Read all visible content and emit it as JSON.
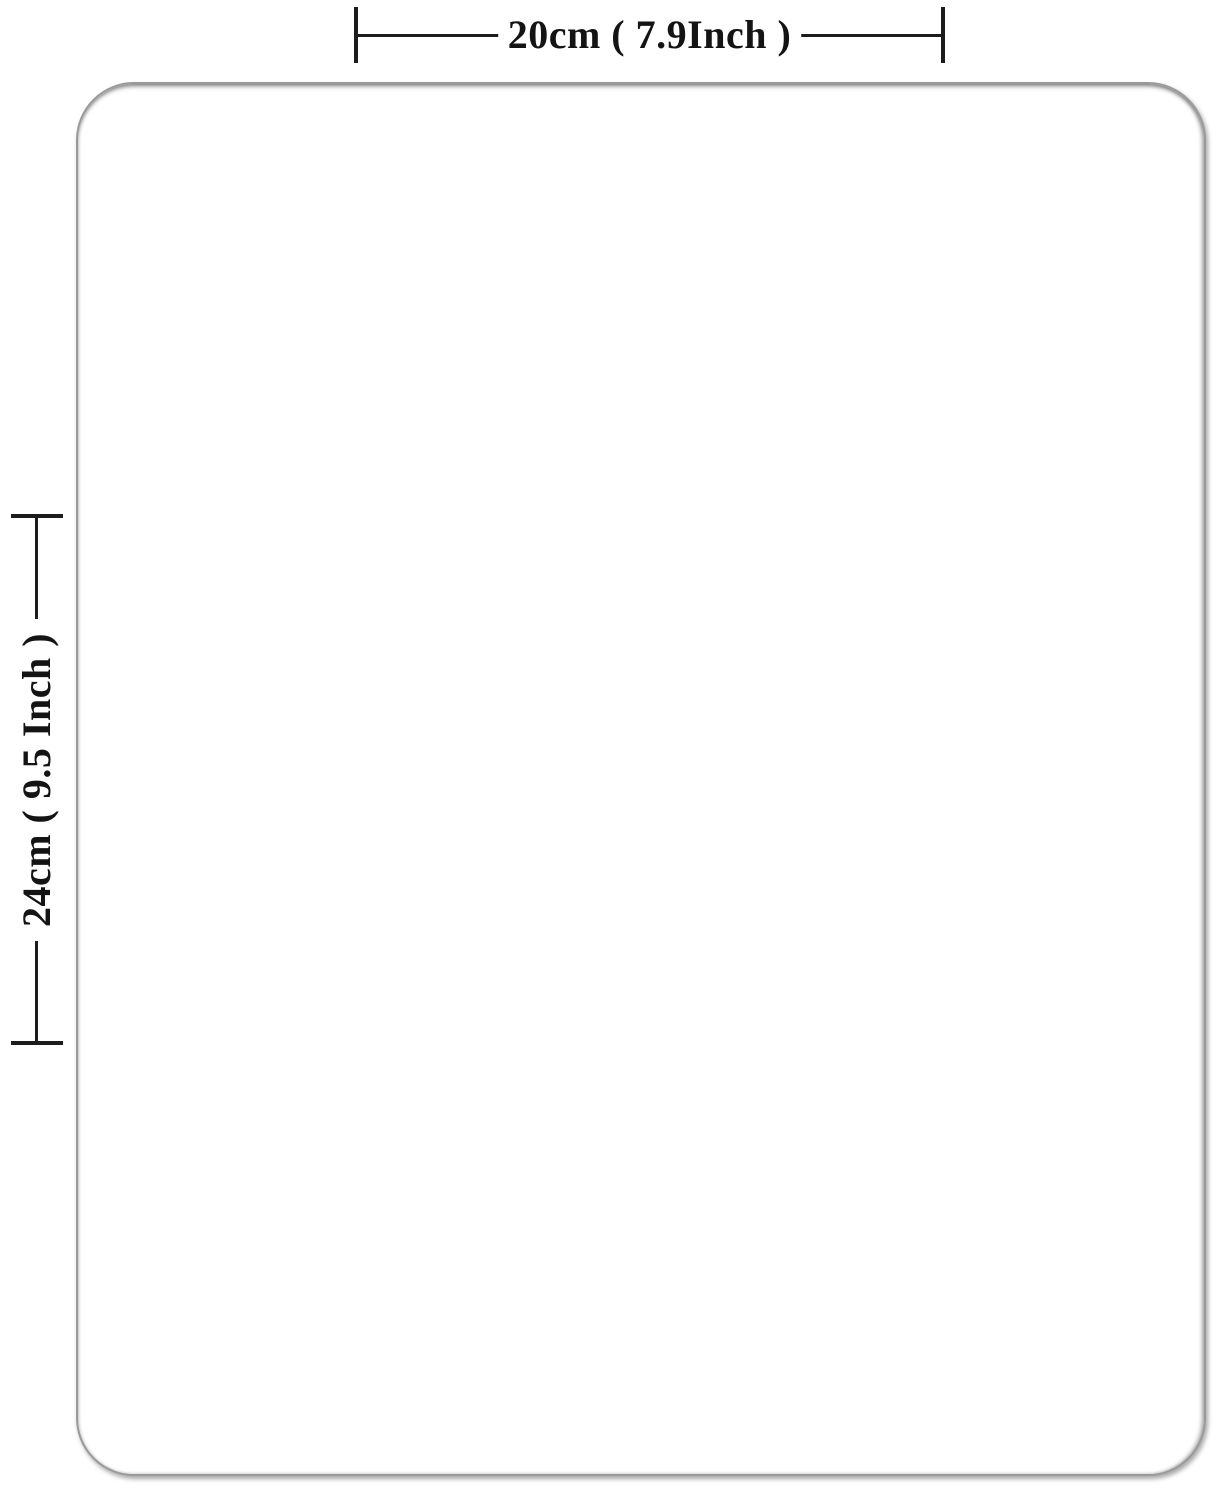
{
  "diagram": {
    "width_label": "20cm ( 7.9Inch )",
    "height_label": "24cm ( 9.5 Inch )"
  },
  "colors": {
    "dimension_line": "#1c1c1c",
    "label_text": "#141414",
    "board_border": "#9a9a9a",
    "background": "#ffffff"
  }
}
